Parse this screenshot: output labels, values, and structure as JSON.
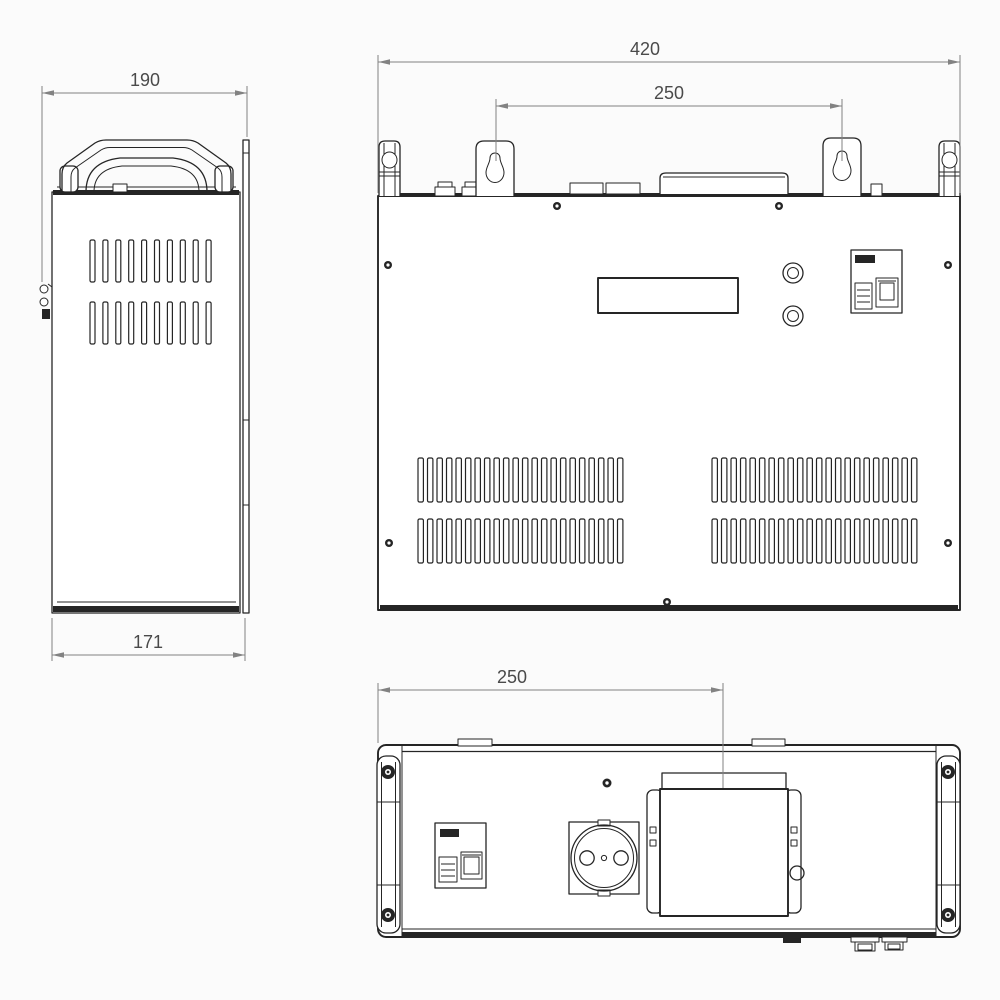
{
  "drawing": {
    "background": "#fbfbfb",
    "line_color": "#252525",
    "dim_line_color": "#828282",
    "dim_text_color": "#4a4a4a",
    "dimensions": {
      "side_width": "190",
      "side_depth": "171",
      "front_width": "420",
      "bracket_spacing": "250",
      "terminal_offset": "250"
    },
    "vents": {
      "side_rows": 2,
      "side_slots_per_row": 10,
      "front_rows": 2,
      "front_left_slots_per_row": 22,
      "front_right_slots_per_row": 22
    }
  }
}
